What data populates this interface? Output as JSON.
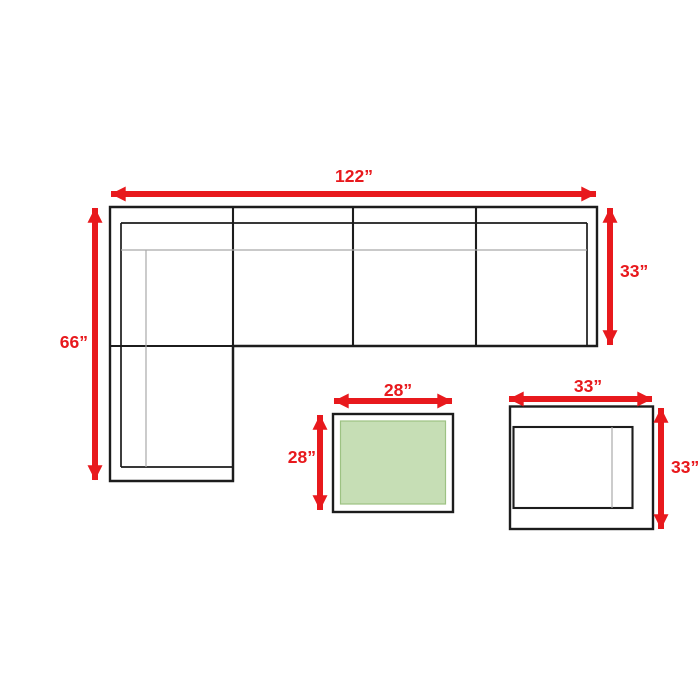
{
  "colors": {
    "arrow": "#e8191d",
    "line": "#1c1c1c",
    "soft_line": "#a9a9a9",
    "table_fill": "#c6deb5",
    "table_stroke": "#9dc283",
    "background": "#ffffff"
  },
  "sectional_sofa": {
    "width_label": "122”",
    "length_label": "66”",
    "depth_label": "33”"
  },
  "coffee_table": {
    "width_label": "28”",
    "depth_label": "28”"
  },
  "end_table": {
    "width_label": "33”",
    "depth_label": "33”"
  }
}
